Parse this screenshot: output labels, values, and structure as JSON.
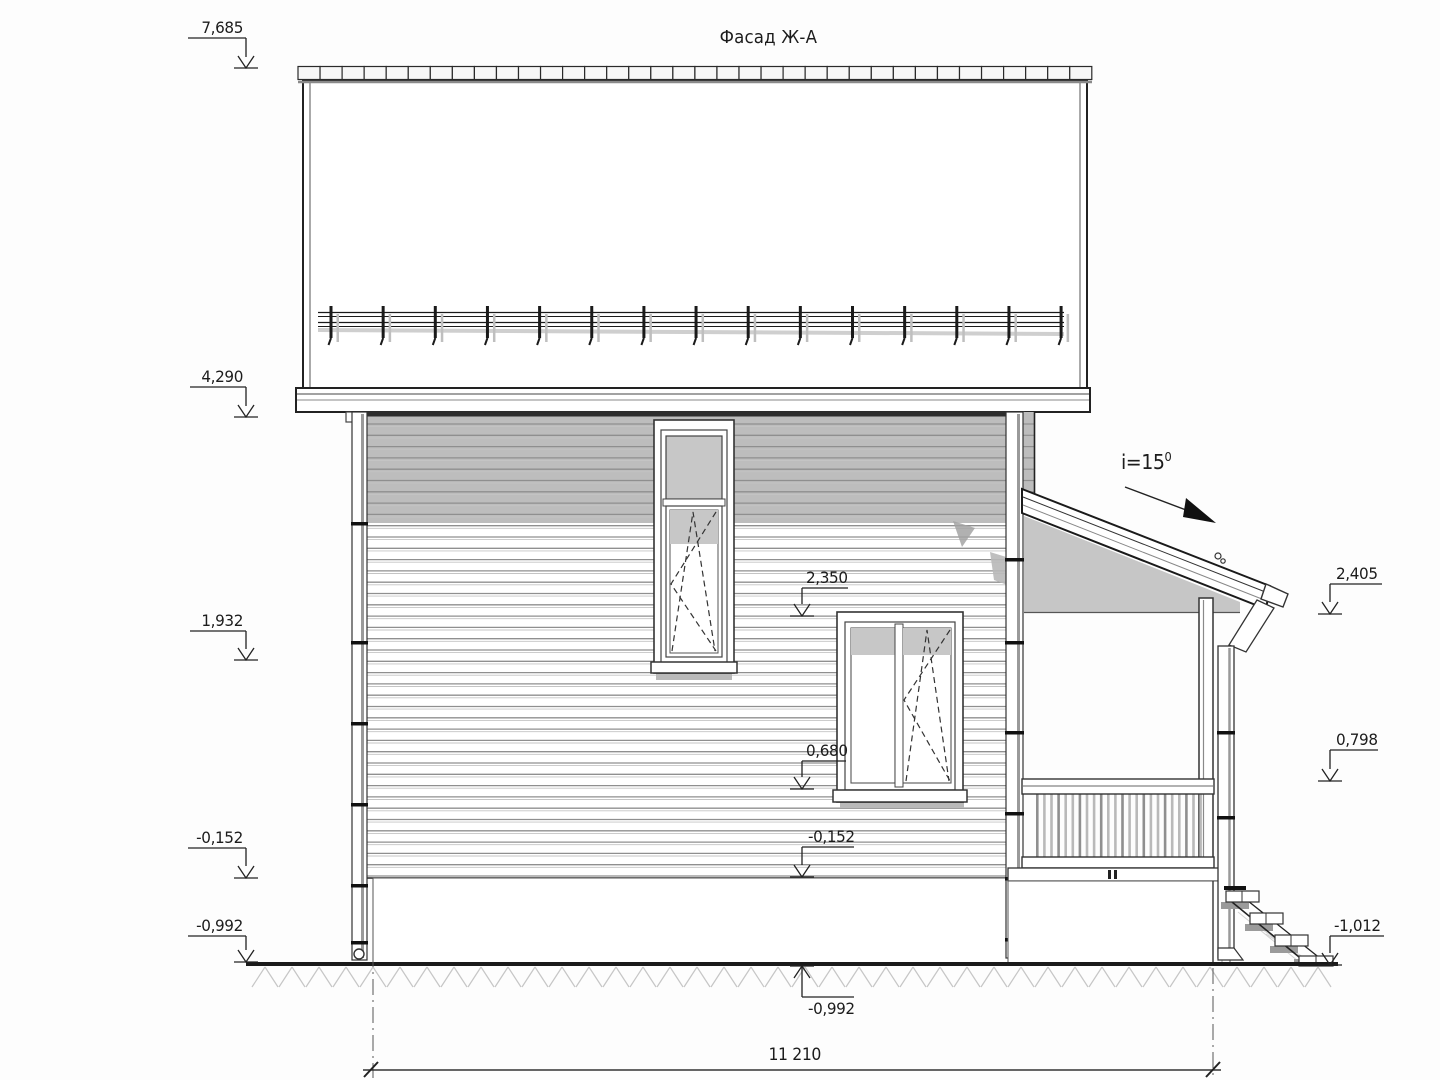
{
  "title": "Фасад Ж-А",
  "slope": {
    "label": "i=15",
    "sup": "0"
  },
  "dimension": {
    "overall_width": "11 210"
  },
  "elevation_marks": {
    "left": [
      "7,685",
      "4,290",
      "1,932",
      "-0,152",
      "-0,992"
    ],
    "middle": [
      "2,350",
      "0,680",
      "-0,152",
      "-0,992"
    ],
    "right": [
      "2,405",
      "0,798",
      "-1,012"
    ]
  }
}
